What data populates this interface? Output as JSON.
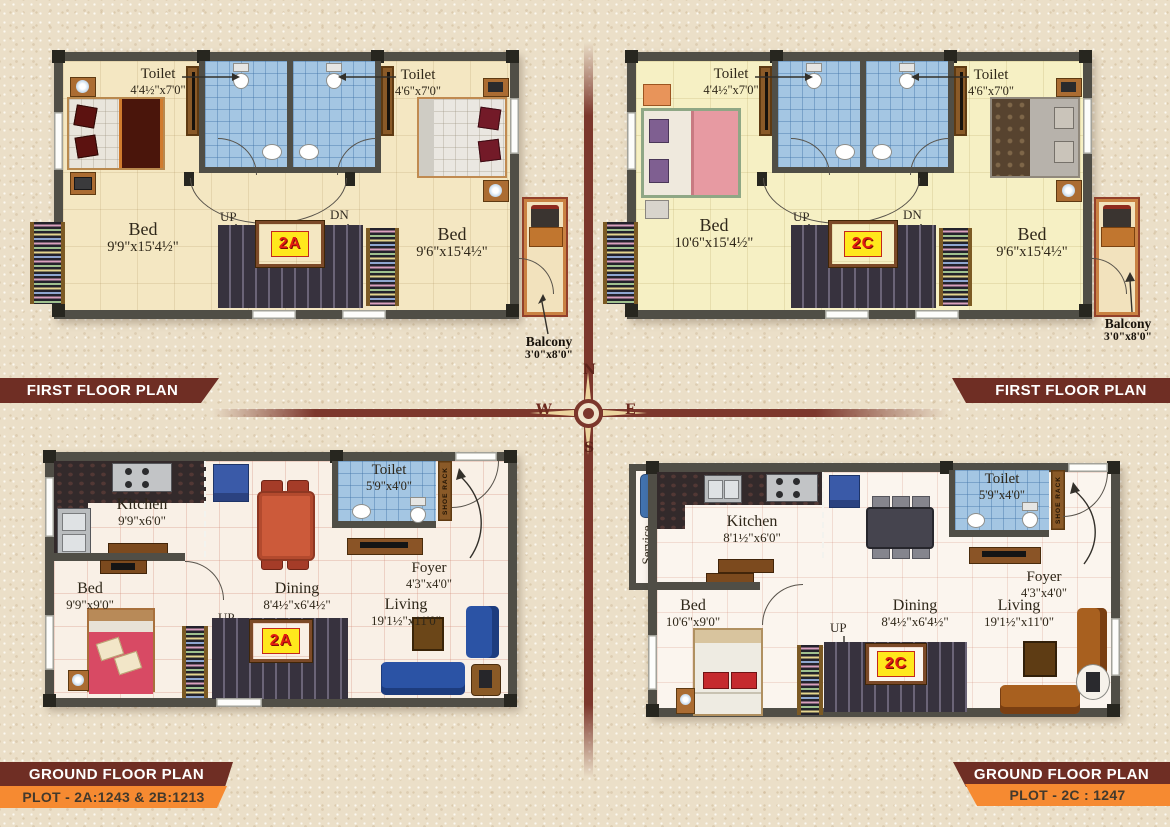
{
  "title_banners": {
    "first_floor": "FIRST FLOOR PLAN",
    "ground_floor": "GROUND FLOOR PLAN",
    "plot_left": "PLOT - 2A:1243 & 2B:1213",
    "plot_right": "PLOT - 2C : 1247"
  },
  "compass": {
    "north": "N",
    "east": "E",
    "south": "S",
    "west": "W"
  },
  "plans": {
    "first_floor_2a": {
      "unit_badge": "2A",
      "toilet_left": {
        "name": "Toilet",
        "dim": "4'4½\"x7'0\""
      },
      "toilet_right": {
        "name": "Toilet",
        "dim": "4'6\"x7'0\""
      },
      "bed_left": {
        "name": "Bed",
        "dim": "9'9\"x15'4½\""
      },
      "bed_right": {
        "name": "Bed",
        "dim": "9'6\"x15'4½\""
      },
      "up": "UP",
      "down": "DN",
      "balcony": {
        "name": "Balcony",
        "dim": "3'0\"x8'0\""
      }
    },
    "first_floor_2c": {
      "unit_badge": "2C",
      "toilet_left": {
        "name": "Toilet",
        "dim": "4'4½\"x7'0\""
      },
      "toilet_right": {
        "name": "Toilet",
        "dim": "4'6\"x7'0\""
      },
      "bed_left": {
        "name": "Bed",
        "dim": "10'6\"x15'4½\""
      },
      "bed_right": {
        "name": "Bed",
        "dim": "9'6\"x15'4½\""
      },
      "up": "UP",
      "down": "DN",
      "balcony": {
        "name": "Balcony",
        "dim": "3'0\"x8'0\""
      }
    },
    "ground_floor_2a": {
      "unit_badge": "2A",
      "kitchen": {
        "name": "Kitchen",
        "dim": "9'9\"x6'0\""
      },
      "toilet": {
        "name": "Toilet",
        "dim": "5'9\"x4'0\""
      },
      "shoe_rack": "SHOE RACK",
      "foyer": {
        "name": "Foyer",
        "dim": "4'3\"x4'0\""
      },
      "bed": {
        "name": "Bed",
        "dim": "9'9\"x9'0\""
      },
      "dining": {
        "name": "Dining",
        "dim": "8'4½\"x6'4½\""
      },
      "living": {
        "name": "Living",
        "dim": "19'1½\"x11'0\""
      },
      "up": "UP"
    },
    "ground_floor_2c": {
      "unit_badge": "2C",
      "service": {
        "name": "Service",
        "dim": "6'0\"x3'0\""
      },
      "kitchen": {
        "name": "Kitchen",
        "dim": "8'1½\"x6'0\""
      },
      "toilet": {
        "name": "Toilet",
        "dim": "5'9\"x4'0\""
      },
      "shoe_rack": "SHOE RACK",
      "foyer": {
        "name": "Foyer",
        "dim": "4'3\"x4'0\""
      },
      "bed": {
        "name": "Bed",
        "dim": "10'6\"x9'0\""
      },
      "dining": {
        "name": "Dining",
        "dim": "8'4½\"x6'4½\""
      },
      "living": {
        "name": "Living",
        "dim": "19'1½\"x11'0\""
      },
      "up": "UP"
    }
  },
  "colors": {
    "banner_maroon": "#6f2e24",
    "banner_orange": "#f68a31",
    "badge_yellow": "#ffe81c",
    "badge_red": "#e31b12",
    "wall_gray": "#504e46",
    "toilet_blue": "#a4c6e3",
    "stairs_dark": "#37323e",
    "compass_maroon": "#7c372c",
    "background_beige": "#ebdfc8"
  }
}
